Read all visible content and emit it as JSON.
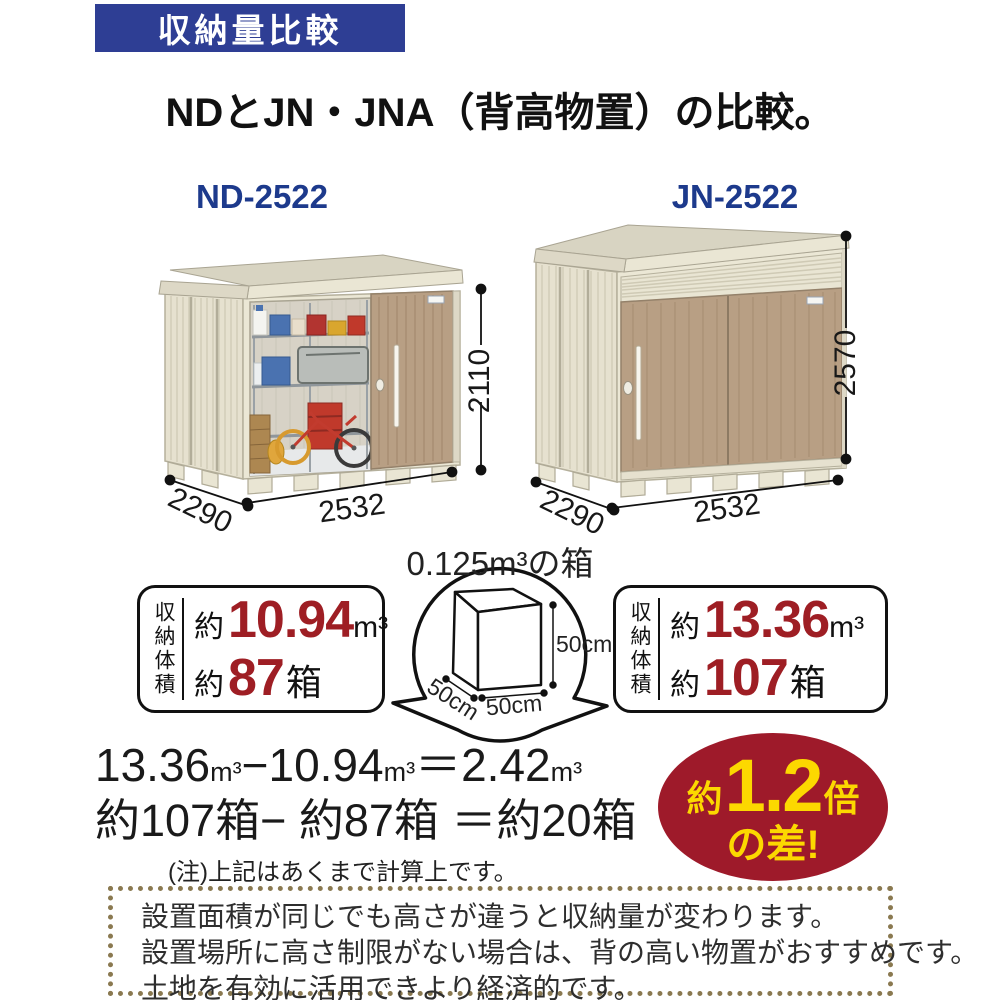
{
  "header": {
    "banner_label": "収納量比較",
    "title": "NDとJN・JNA（背高物置）の比較。"
  },
  "sheds": {
    "nd": {
      "model": "ND-2522",
      "height_mm": "2110",
      "depth_mm": "2290",
      "width_mm": "2532"
    },
    "jn": {
      "model": "JN-2522",
      "height_mm": "2570",
      "depth_mm": "2290",
      "width_mm": "2532"
    }
  },
  "reference_box": {
    "caption": "0.125m³の箱",
    "height": "50cm",
    "width": "50cm",
    "depth": "50cm"
  },
  "capacity": {
    "nd": {
      "label": "収納体積",
      "volume_prefix": "約",
      "volume_value": "10.94",
      "volume_unit": "m³",
      "boxes_prefix": "約",
      "boxes_value": "87",
      "boxes_unit": "箱"
    },
    "jn": {
      "label": "収納体積",
      "volume_prefix": "約",
      "volume_value": "13.36",
      "volume_unit": "m³",
      "boxes_prefix": "約",
      "boxes_value": "107",
      "boxes_unit": "箱"
    }
  },
  "calculation": {
    "volume_line": {
      "a": "13.36",
      "a_unit": "m³",
      "minus": "−",
      "b": "10.94",
      "b_unit": "m³",
      "equals": "＝",
      "result": "2.42",
      "result_unit": "m³"
    },
    "boxes_line": "約107箱− 約87箱 ＝約20箱",
    "note": "(注)上記はあくまで計算上です。"
  },
  "badge": {
    "prefix": "約",
    "value": "1.2",
    "suffix": "倍",
    "line2": "の差!"
  },
  "footer": {
    "lines": [
      "設置面積が同じでも高さが違うと収納量が変わります。",
      "設置場所に高さ制限がない場合は、背の高い物置がおすすめです。",
      "土地を有効に活用できより経済的です。"
    ]
  },
  "colors": {
    "banner_blue": "#2e3e94",
    "model_blue": "#1d3a8c",
    "accent_red": "#9e1e24",
    "badge_red": "#9e1a2a",
    "badge_yellow": "#fcd800",
    "footer_dot_brown": "#8a7950",
    "shed_wall_cream": "#ebe7d5",
    "shed_door_tan": "#b89f84"
  }
}
